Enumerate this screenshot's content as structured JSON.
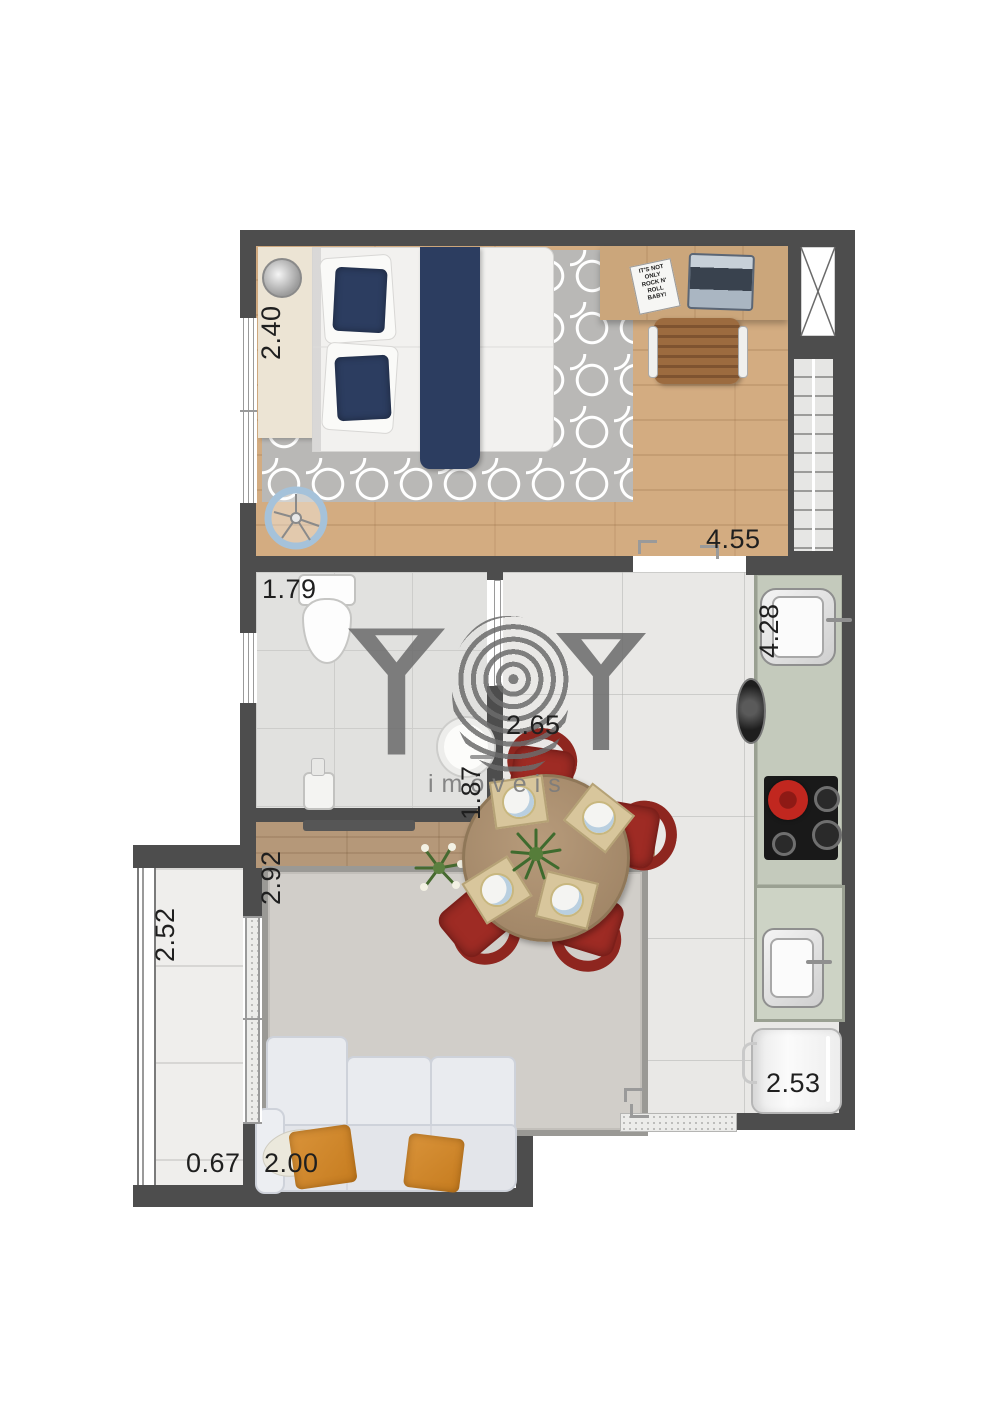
{
  "watermark": {
    "brand": "YBY",
    "subtitle": "imóveis"
  },
  "labels": {
    "bedroom_width": "2.40",
    "bedroom_length": "4.55",
    "bathroom_width": "1.79",
    "bathroom_depth": "1.87",
    "kitchen_length": "4.28",
    "dining_width": "2.65",
    "hall_length": "2.92",
    "living_width": "2.00",
    "balcony_length": "2.52",
    "balcony_width": "0.67",
    "service_width": "2.53"
  },
  "poster": {
    "line1": "IT'S NOT",
    "line2": "ONLY",
    "line3": "ROCK N'",
    "line4": "ROLL",
    "line5": "BABY!"
  },
  "colors": {
    "wall": "#4d4d4d",
    "wood_floor": "#d3ac81",
    "counter_sage": "#c4cabc",
    "chair_red": "#9e2b24",
    "bedding_navy": "#2c3d60",
    "pillow_orange": "#cf8527",
    "watermark_gray": "#6b6b6b"
  }
}
